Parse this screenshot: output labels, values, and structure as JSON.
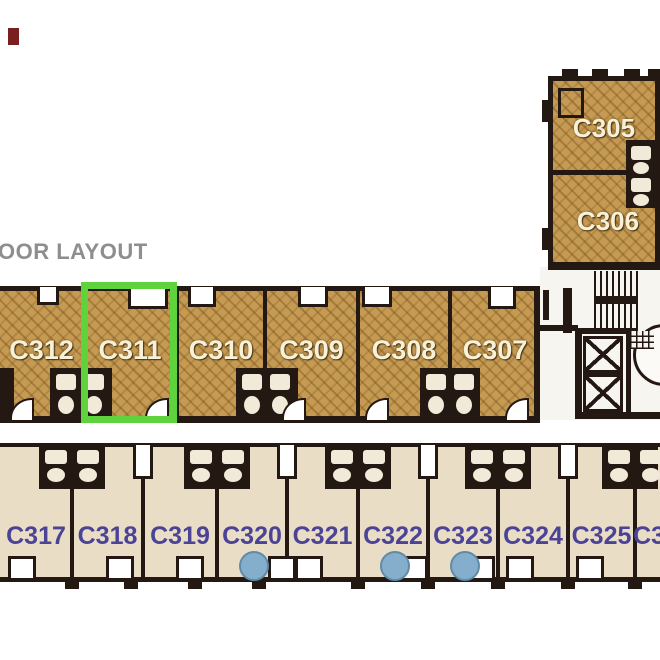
{
  "page": {
    "title": "OOR LAYOUT"
  },
  "colors": {
    "wall": "#241812",
    "wood_floor": "#c59a52",
    "wood_floor_stripe": "#9c7330",
    "beige_floor": "#eaddc6",
    "beige_floor_edge": "#d9c8a9",
    "unit_label_light": "#f7f1d8",
    "unit_label_blue": "#4b4396",
    "highlight_green": "#5fd33c",
    "marker_blue": "#84aecb",
    "marker_blue_edge": "#5f8ba8",
    "title_gray": "#8e8e8e",
    "marker_red": "#7a1f1f",
    "fixture_light": "#f2ead8",
    "core_floor": "#f7f5f0"
  },
  "top_section": {
    "units": [
      {
        "id": "C305"
      },
      {
        "id": "C306"
      }
    ]
  },
  "middle_row": {
    "highlighted_unit": "C311",
    "units": [
      {
        "id": "C312"
      },
      {
        "id": "C311"
      },
      {
        "id": "C310"
      },
      {
        "id": "C309"
      },
      {
        "id": "C308"
      },
      {
        "id": "C307"
      }
    ]
  },
  "bottom_row": {
    "units": [
      {
        "id": "C317",
        "marker": false
      },
      {
        "id": "C318",
        "marker": false
      },
      {
        "id": "C319",
        "marker": false
      },
      {
        "id": "C320",
        "marker": true
      },
      {
        "id": "C321",
        "marker": false
      },
      {
        "id": "C322",
        "marker": true
      },
      {
        "id": "C323",
        "marker": true
      },
      {
        "id": "C324",
        "marker": false
      },
      {
        "id": "C325",
        "marker": false
      },
      {
        "id": "C326",
        "marker": false
      }
    ]
  },
  "core": {
    "elements": [
      "stairs",
      "elevator",
      "elevator",
      "round-room"
    ]
  }
}
